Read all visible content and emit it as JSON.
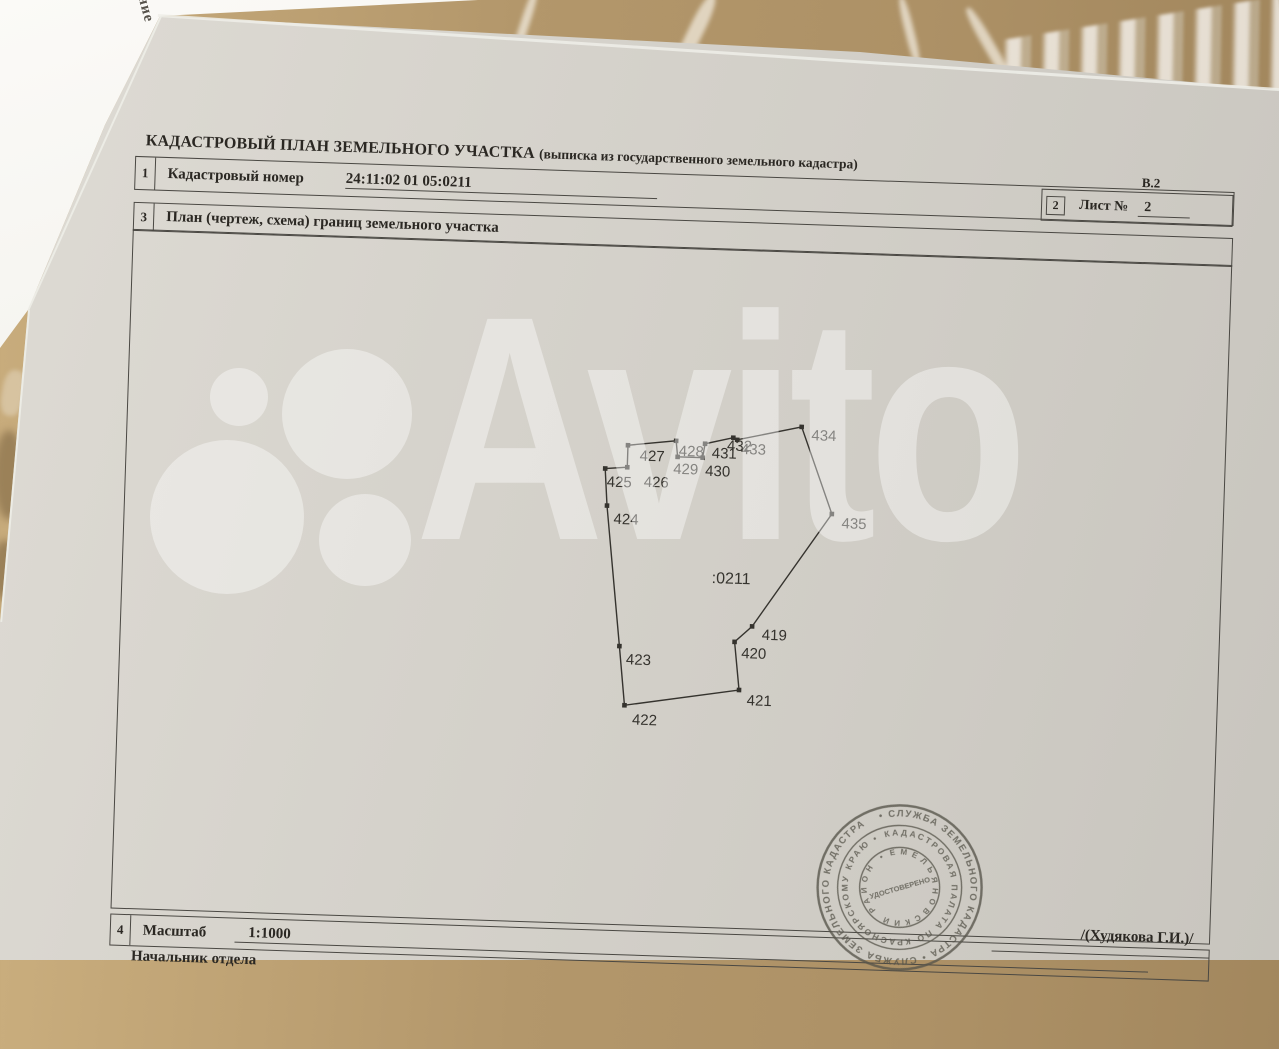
{
  "photo": {
    "surface": "marble-table",
    "back_sheet_fragment": "ние",
    "colors": {
      "marble": "#b3976b",
      "paper": "#d6d3cc",
      "back_sheet": "#f6f5f1",
      "ink": "#2b2823",
      "line": "#4a4843",
      "stamp_ink": "#56544a",
      "watermark": "rgba(255,255,255,0.40)"
    },
    "watermark": {
      "brand_text": "Avito"
    }
  },
  "document": {
    "title_main": "КАДАСТРОВЫЙ ПЛАН ЗЕМЕЛЬНОГО УЧАСТКА ",
    "title_note": "(выписка из государственного земельного кадастра)",
    "form_code": "В.2",
    "row1": {
      "num": "1",
      "label": "Кадастровый номер",
      "value": "24:11:02 01 05:0211"
    },
    "sheet_box": {
      "num": "2",
      "label": "Лист №",
      "value": "2"
    },
    "row3": {
      "num": "3",
      "label": "План (чертеж, схема) границ земельного участка"
    },
    "row4": {
      "num": "4",
      "label": "Масштаб",
      "value": "1:1000"
    },
    "footer_left": "Начальник отдела",
    "signature": "/(Худякова Г.И.)/"
  },
  "plan": {
    "parcel_label": ":0211",
    "parcel_label_pos": {
      "x": 588,
      "y": 336
    },
    "outline_closed": true,
    "points": [
      {
        "n": "422",
        "x": 505,
        "y": 461,
        "lx": 513,
        "ly": 480
      },
      {
        "n": "423",
        "x": 498,
        "y": 402,
        "lx": 505,
        "ly": 420
      },
      {
        "n": "424",
        "x": 481,
        "y": 262,
        "lx": 488,
        "ly": 280
      },
      {
        "n": "425",
        "x": 478,
        "y": 225,
        "lx": 480,
        "ly": 243
      },
      {
        "n": "426",
        "x": 500,
        "y": 223,
        "lx": 517,
        "ly": 242
      },
      {
        "n": "427",
        "x": 500,
        "y": 201,
        "lx": 512,
        "ly": 216
      },
      {
        "n": "428",
        "x": 548,
        "y": 195,
        "lx": 551,
        "ly": 210
      },
      {
        "n": "429",
        "x": 550,
        "y": 211,
        "lx": 546,
        "ly": 228
      },
      {
        "n": "430",
        "x": 575,
        "y": 211,
        "lx": 578,
        "ly": 229
      },
      {
        "n": "431",
        "x": 577,
        "y": 197,
        "lx": 584,
        "ly": 211
      },
      {
        "n": "432",
        "x": 605,
        "y": 190,
        "lx": 599,
        "ly": 203
      },
      {
        "n": "433",
        "x": 609,
        "y": 192,
        "lx": 613,
        "ly": 206
      },
      {
        "n": "434",
        "x": 673,
        "y": 177,
        "lx": 683,
        "ly": 190
      },
      {
        "n": "435",
        "x": 706,
        "y": 263,
        "lx": 716,
        "ly": 277
      },
      {
        "n": "419",
        "x": 630,
        "y": 378,
        "lx": 640,
        "ly": 391
      },
      {
        "n": "420",
        "x": 613,
        "y": 394,
        "lx": 620,
        "ly": 410
      },
      {
        "n": "421",
        "x": 619,
        "y": 442,
        "lx": 627,
        "ly": 457
      }
    ]
  },
  "stamp": {
    "ring_outer": "• СЛУЖБА  ЗЕМЕЛЬНОГО  КАДАСТРА  •  СЛУЖБА  ЗЕМЕЛЬНОГО  КАДАСТРА",
    "ring_middle": "КАДАСТРОВАЯ  ПАЛАТА  ПО  КРАСНОЯРСКОМУ  КРАЮ  •",
    "ring_inner": "ЕМЕЛЬЯНОВСКИЙ  РАЙОН  •",
    "center": "УДОСТОВЕРЕНО"
  }
}
